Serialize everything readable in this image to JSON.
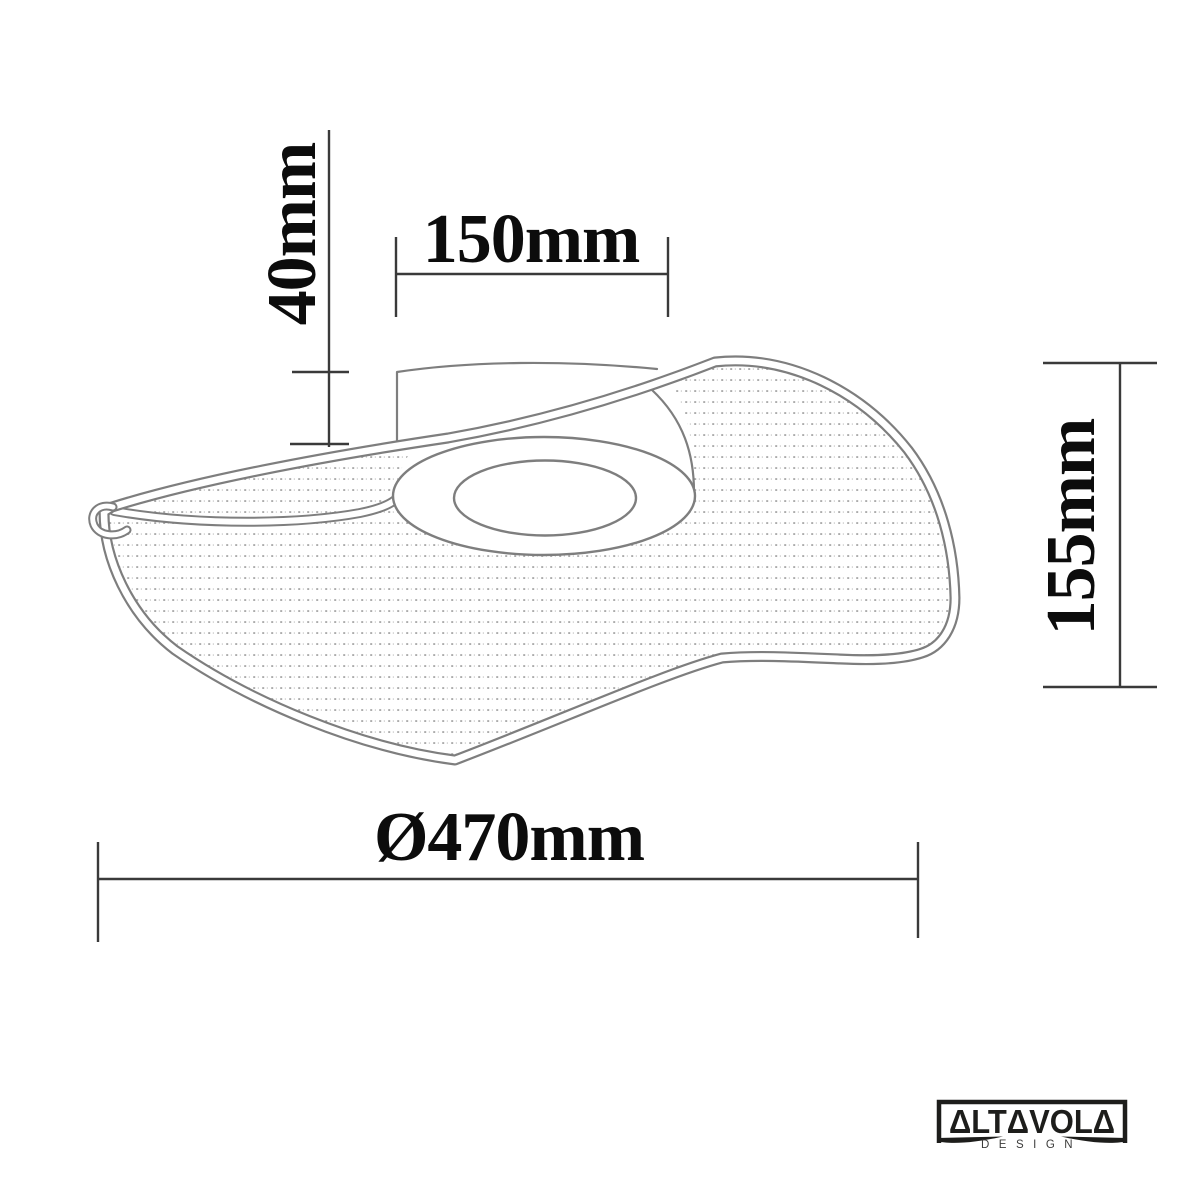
{
  "figure": {
    "type": "technical-dimension-drawing",
    "subject": "Wave-shaped ceiling lamp line drawing with dimensions",
    "background": "#ffffff",
    "line_color": "#7e7e7e",
    "dimension_line_color": "#3a3a3a",
    "label_color": "#0c0c0c",
    "texture": "stipple-dots"
  },
  "dimensions": {
    "canopy_height": "40mm",
    "canopy_width": "150mm",
    "fixture_height": "155mm",
    "diameter": "Ø470mm"
  },
  "logo": {
    "brand": "ΔLTΔVOLΔ",
    "subtitle": "DESIGN",
    "color": "#1d1d1b"
  }
}
